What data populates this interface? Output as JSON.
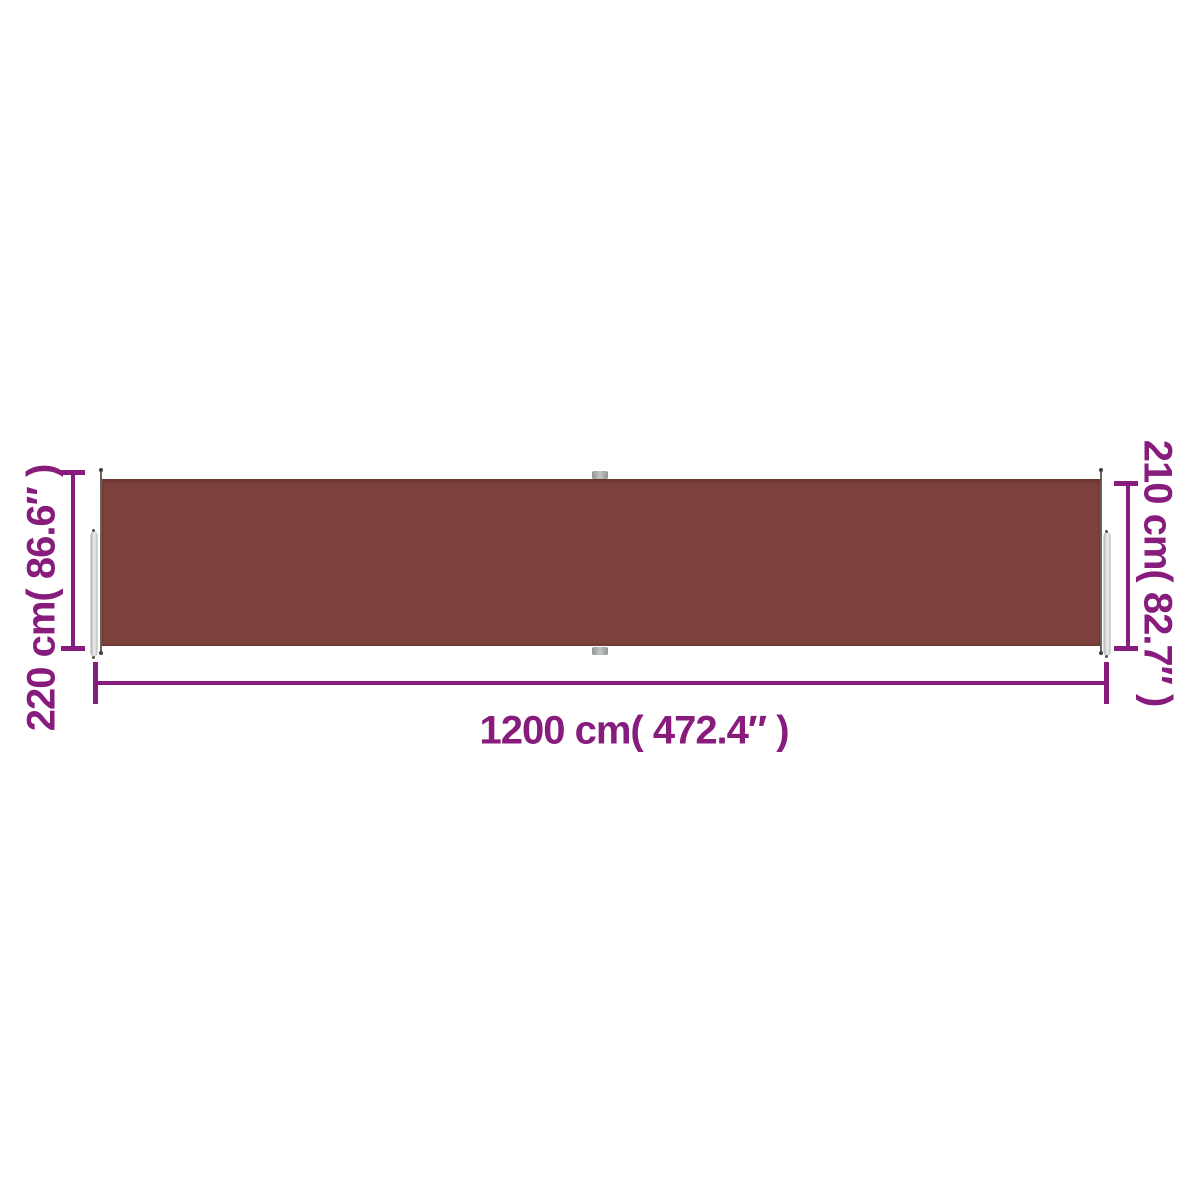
{
  "colors": {
    "accent": "#871c7d",
    "fabric": "#7e423d",
    "pole_light": "#f4f6f5",
    "pole_dark": "#9aa09e",
    "background": "#ffffff"
  },
  "dimensions": {
    "left_height": "220 cm( 86.6″ )",
    "right_height": "210 cm( 82.7″ )",
    "bottom_width": "1200 cm( 472.4″ )"
  }
}
